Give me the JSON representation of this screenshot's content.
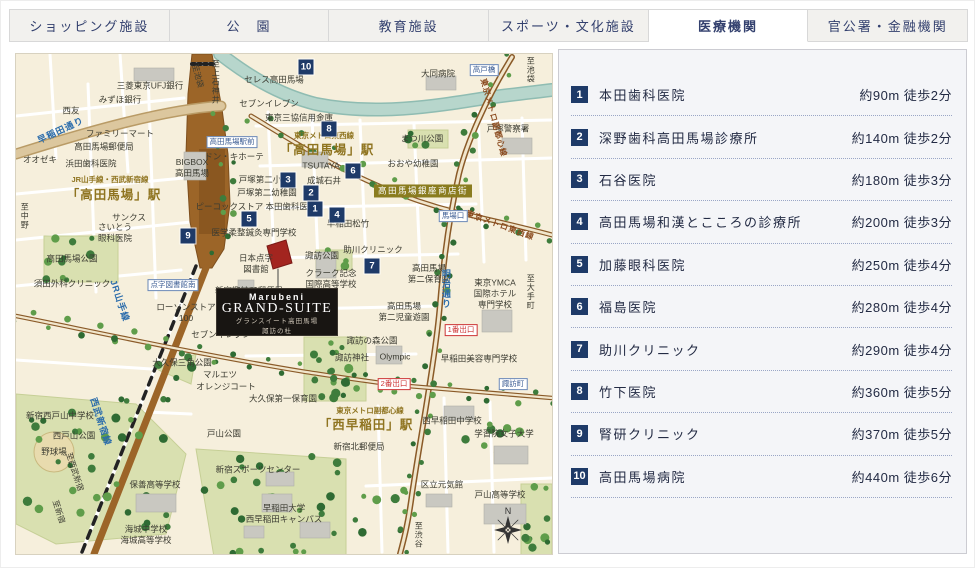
{
  "tabs": {
    "items": [
      {
        "label": "ショッピング施設",
        "active": false
      },
      {
        "label": "公　園",
        "active": false
      },
      {
        "label": "教育施設",
        "active": false
      },
      {
        "label": "スポーツ・文化施設",
        "active": false
      },
      {
        "label": "医療機関",
        "active": true
      },
      {
        "label": "官公署・金融機関",
        "active": false
      }
    ]
  },
  "facilities": {
    "items": [
      {
        "no": "1",
        "name": "本田歯科医院",
        "distance": "約90m",
        "walk": "徒歩2分"
      },
      {
        "no": "2",
        "name": "深野歯科高田馬場診療所",
        "distance": "約140m",
        "walk": "徒歩2分"
      },
      {
        "no": "3",
        "name": "石谷医院",
        "distance": "約180m",
        "walk": "徒歩3分"
      },
      {
        "no": "4",
        "name": "高田馬場和漢とこころの診療所",
        "distance": "約200m",
        "walk": "徒歩3分"
      },
      {
        "no": "5",
        "name": "加藤眼科医院",
        "distance": "約250m",
        "walk": "徒歩4分"
      },
      {
        "no": "6",
        "name": "福島医院",
        "distance": "約280m",
        "walk": "徒歩4分"
      },
      {
        "no": "7",
        "name": "助川クリニック",
        "distance": "約290m",
        "walk": "徒歩4分"
      },
      {
        "no": "8",
        "name": "竹下医院",
        "distance": "約360m",
        "walk": "徒歩5分"
      },
      {
        "no": "9",
        "name": "腎研クリニック",
        "distance": "約370m",
        "walk": "徒歩5分"
      },
      {
        "no": "10",
        "name": "高田馬場病院",
        "distance": "約440m",
        "walk": "徒歩6分"
      }
    ]
  },
  "map": {
    "property": {
      "brand": "Marubeni",
      "name": "GRAND-SUITE",
      "sub1": "グランスイート高田馬場",
      "sub2": "諏訪の杜"
    },
    "compass_n": "N",
    "colors": {
      "badge_navy": "#1e3a68",
      "railway_brown": "#9c6528",
      "river_teal": "#b7d6cc",
      "park_green": "#d9e0b0",
      "road_tan": "#dcc79e",
      "property_red": "#a3251f",
      "station_gold": "#8f7420",
      "shopping_badge_olive": "#8a7c1f"
    },
    "labels": [
      {
        "t": "三菱東京UFJ銀行",
        "x": 134,
        "y": 32,
        "cls": "s"
      },
      {
        "t": "みずほ銀行",
        "x": 104,
        "y": 46,
        "cls": "s"
      },
      {
        "t": "西友",
        "x": 55,
        "y": 57,
        "cls": "s"
      },
      {
        "t": "ファミリーマート",
        "x": 104,
        "y": 80,
        "cls": "s"
      },
      {
        "t": "オオゼキ",
        "x": 24,
        "y": 106,
        "cls": "s"
      },
      {
        "t": "高田馬場郵便局",
        "x": 88,
        "y": 93,
        "cls": "s"
      },
      {
        "t": "浜田歯科医院",
        "x": 75,
        "y": 110,
        "cls": "s"
      },
      {
        "t": "サンクス",
        "x": 113,
        "y": 164,
        "cls": "s"
      },
      {
        "lines": [
          "さいとう",
          "眼科医院"
        ],
        "x": 99,
        "y": 179,
        "cls": "s"
      },
      {
        "t": "高田馬場公園",
        "x": 56,
        "y": 205,
        "cls": "s"
      },
      {
        "t": "須田外科クリニック",
        "x": 56,
        "y": 230,
        "cls": "s"
      },
      {
        "t": "医学柔整鍼灸専門学校",
        "x": 238,
        "y": 179,
        "cls": "s"
      },
      {
        "lines": [
          "日本点字",
          "図書館"
        ],
        "x": 240,
        "y": 210,
        "cls": "s"
      },
      {
        "t": "新宿諏訪町郵便局",
        "x": 233,
        "y": 237,
        "cls": "s"
      },
      {
        "lines": [
          "ローソンストア",
          "100"
        ],
        "x": 170,
        "y": 259,
        "cls": "s"
      },
      {
        "t": "セブンイレブン",
        "x": 205,
        "y": 281,
        "cls": "s"
      },
      {
        "lines": [
          "クラーク記念",
          "国際高等学校"
        ],
        "x": 315,
        "y": 225,
        "cls": "s"
      },
      {
        "t": "諏訪公園",
        "x": 306,
        "y": 202,
        "cls": "s"
      },
      {
        "t": "助川クリニック",
        "x": 357,
        "y": 196,
        "cls": "s"
      },
      {
        "lines": [
          "高田馬場",
          "第二保育園"
        ],
        "x": 413,
        "y": 220,
        "cls": "s"
      },
      {
        "lines": [
          "高田馬場",
          "第二児童遊園"
        ],
        "x": 388,
        "y": 258,
        "cls": "s"
      },
      {
        "t": "諏訪の森公園",
        "x": 356,
        "y": 287,
        "cls": "s"
      },
      {
        "t": "諏訪神社",
        "x": 336,
        "y": 304,
        "cls": "s"
      },
      {
        "t": "Olympic",
        "x": 379,
        "y": 303,
        "cls": "s"
      },
      {
        "t": "早稲田美容専門学校",
        "x": 463,
        "y": 305,
        "cls": "s"
      },
      {
        "lines": [
          "東京YMCA",
          "国際ホテル",
          "専門学校"
        ],
        "x": 479,
        "y": 240,
        "cls": "s"
      },
      {
        "t": "早稲田松竹",
        "x": 332,
        "y": 170,
        "cls": "s"
      },
      {
        "t": "セブンイレブン",
        "x": 253,
        "y": 50,
        "cls": "s"
      },
      {
        "t": "セレス高田馬場",
        "x": 258,
        "y": 26,
        "cls": "s"
      },
      {
        "t": "東京三協信用金庫",
        "x": 283,
        "y": 64,
        "cls": "s"
      },
      {
        "t": "大同病院",
        "x": 422,
        "y": 20,
        "cls": "s"
      },
      {
        "t": "まつ川公園",
        "x": 406,
        "y": 85,
        "cls": "s"
      },
      {
        "t": "おおや幼稚園",
        "x": 397,
        "y": 110,
        "cls": "s"
      },
      {
        "t": "戸塚警察署",
        "x": 492,
        "y": 75,
        "cls": "s"
      },
      {
        "t": "ドン・キホーテ",
        "x": 218,
        "y": 103,
        "cls": "s"
      },
      {
        "lines": [
          "BIGBOX",
          "高田馬場"
        ],
        "x": 176,
        "y": 114,
        "cls": "s"
      },
      {
        "t": "戸塚第二小",
        "x": 244,
        "y": 126,
        "cls": "s"
      },
      {
        "t": "戸塚第二幼稚園",
        "x": 251,
        "y": 139,
        "cls": "s"
      },
      {
        "t": "TSUTAYA",
        "x": 305,
        "y": 112,
        "cls": "s"
      },
      {
        "t": "成城石井",
        "x": 308,
        "y": 127,
        "cls": "s"
      },
      {
        "t": "ピーコックストア 本田歯科医院",
        "x": 240,
        "y": 153,
        "cls": "s"
      },
      {
        "t": "新宿西戸山中学校",
        "x": 44,
        "y": 362,
        "cls": "s"
      },
      {
        "t": "西戸山公園",
        "x": 58,
        "y": 382,
        "cls": "s"
      },
      {
        "t": "野球場",
        "x": 38,
        "y": 398,
        "cls": "s"
      },
      {
        "t": "保善高等学校",
        "x": 139,
        "y": 431,
        "cls": "s"
      },
      {
        "lines": [
          "海城中学校",
          "海城高等学校"
        ],
        "x": 130,
        "y": 481,
        "cls": "s"
      },
      {
        "t": "マルエツ",
        "x": 204,
        "y": 321,
        "cls": "s"
      },
      {
        "t": "オレンジコート",
        "x": 210,
        "y": 333,
        "cls": "s"
      },
      {
        "t": "大久保三角公園",
        "x": 166,
        "y": 309,
        "cls": "s"
      },
      {
        "t": "大久保第一保育園",
        "x": 267,
        "y": 345,
        "cls": "s"
      },
      {
        "t": "新宿スポーツセンター",
        "x": 242,
        "y": 416,
        "cls": "s"
      },
      {
        "t": "戸山公園",
        "x": 208,
        "y": 380,
        "cls": "s"
      },
      {
        "lines": [
          "早稲田大学",
          "西早稲田キャンパス"
        ],
        "x": 268,
        "y": 460,
        "cls": "s"
      },
      {
        "t": "新宿北郵便局",
        "x": 343,
        "y": 393,
        "cls": "s"
      },
      {
        "t": "西早稲田中学校",
        "x": 436,
        "y": 367,
        "cls": "s"
      },
      {
        "t": "学習院女子大学",
        "x": 488,
        "y": 380,
        "cls": "s"
      },
      {
        "t": "区立元気館",
        "x": 426,
        "y": 431,
        "cls": "s"
      },
      {
        "t": "戸山高等学校",
        "x": 484,
        "y": 441,
        "cls": "s"
      },
      {
        "t": "JR山手線・西武新宿線",
        "x": 94,
        "y": 126,
        "cls": "g"
      },
      {
        "t": "「高田馬場」駅",
        "x": 98,
        "y": 141,
        "cls": "G"
      },
      {
        "t": "東京メトロ東西線",
        "x": 308,
        "y": 82,
        "cls": "g"
      },
      {
        "t": "「高田馬場」駅",
        "x": 311,
        "y": 96,
        "cls": "G"
      },
      {
        "t": "東京メトロ副都心線",
        "x": 354,
        "y": 357,
        "cls": "g"
      },
      {
        "t": "「西早稲田」駅",
        "x": 350,
        "y": 371,
        "cls": "G"
      },
      {
        "t": "早稲田通り",
        "x": 45,
        "y": 77,
        "cls": "r",
        "rot": -25
      },
      {
        "t": "明治通り",
        "x": 429,
        "y": 235,
        "cls": "r v"
      },
      {
        "t": "JR山手線",
        "x": 103,
        "y": 247,
        "cls": "r",
        "rot": 72
      },
      {
        "t": "西武新宿線",
        "x": 84,
        "y": 368,
        "cls": "r",
        "rot": 72
      },
      {
        "t": "至西武新宿",
        "x": 58,
        "y": 418,
        "cls": "dir",
        "rot": 72
      },
      {
        "t": "至新宿",
        "x": 42,
        "y": 458,
        "cls": "dir",
        "rot": 72
      },
      {
        "t": "東京メトロ東西線",
        "x": 484,
        "y": 172,
        "cls": "b",
        "rot": 20
      },
      {
        "t": "東京メトロ副都心線",
        "x": 477,
        "y": 64,
        "cls": "b",
        "rot": 75
      },
      {
        "t": "至中野",
        "x": 8,
        "y": 162,
        "cls": "dir v"
      },
      {
        "t": "至上石神井",
        "x": 199,
        "y": 28,
        "cls": "dir v"
      },
      {
        "t": "至池袋",
        "x": 181,
        "y": 22,
        "cls": "dir",
        "rot": 75
      },
      {
        "t": "至池袋",
        "x": 514,
        "y": 16,
        "cls": "dir v"
      },
      {
        "t": "至大手町",
        "x": 514,
        "y": 238,
        "cls": "dir v"
      },
      {
        "t": "至渋谷",
        "x": 402,
        "y": 481,
        "cls": "dir v"
      },
      {
        "t": "高田馬場駅前",
        "x": 216,
        "y": 88,
        "cls": "lblb"
      },
      {
        "t": "点字図書館南",
        "x": 157,
        "y": 231,
        "cls": "lblb"
      },
      {
        "t": "馬場口",
        "x": 437,
        "y": 162,
        "cls": "lblb"
      },
      {
        "t": "高戸橋",
        "x": 468,
        "y": 16,
        "cls": "lblb"
      },
      {
        "t": "諏訪町",
        "x": 497,
        "y": 330,
        "cls": "lblb"
      },
      {
        "t": "1番出口",
        "x": 445,
        "y": 276,
        "cls": "lblr"
      },
      {
        "t": "2番出口",
        "x": 378,
        "y": 330,
        "cls": "lblr"
      },
      {
        "t": "高田馬場銀座商店街",
        "x": 407,
        "y": 137,
        "cls": "bdg"
      }
    ],
    "markers": [
      {
        "no": "1",
        "x": 299,
        "y": 155
      },
      {
        "no": "2",
        "x": 295,
        "y": 139
      },
      {
        "no": "3",
        "x": 272,
        "y": 126
      },
      {
        "no": "4",
        "x": 321,
        "y": 161
      },
      {
        "no": "5",
        "x": 233,
        "y": 165
      },
      {
        "no": "6",
        "x": 337,
        "y": 117
      },
      {
        "no": "7",
        "x": 356,
        "y": 212
      },
      {
        "no": "8",
        "x": 313,
        "y": 75
      },
      {
        "no": "9",
        "x": 172,
        "y": 182
      },
      {
        "no": "10",
        "x": 290,
        "y": 13
      }
    ]
  }
}
